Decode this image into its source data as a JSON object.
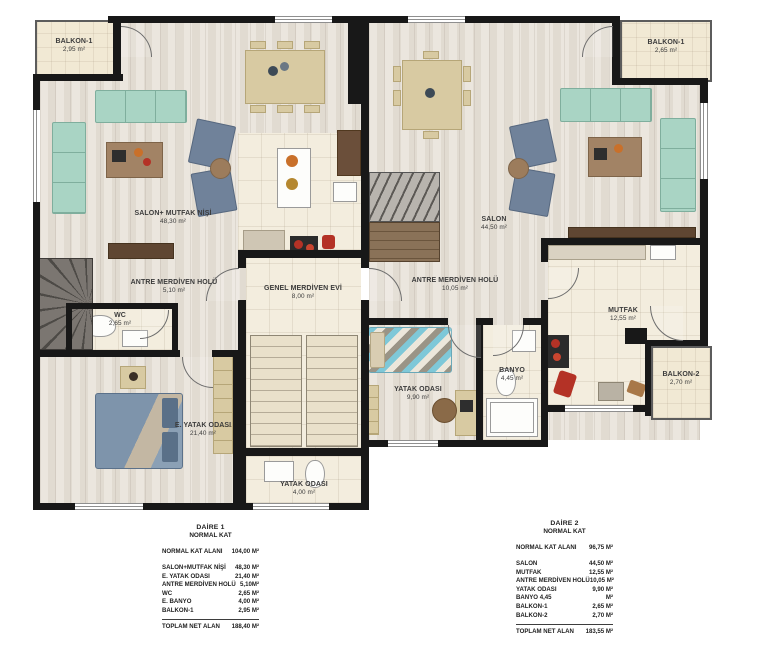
{
  "plan": {
    "rooms": [
      {
        "name": "BALKON-1",
        "area": "2,95 m²"
      },
      {
        "name": "SALON+ MUTFAK NİŞİ",
        "area": "48,30 m²"
      },
      {
        "name": "ANTRE MERDİVEN HOLÜ",
        "area": "5,10 m²"
      },
      {
        "name": "WC",
        "area": "2,65 m²"
      },
      {
        "name": "E. YATAK ODASI",
        "area": "21,40 m²"
      },
      {
        "name": "YATAK ODASI",
        "area": "4,00 m²"
      },
      {
        "name": "GENEL MERDİVEN EVİ",
        "area": "8,00 m²"
      },
      {
        "name": "SALON",
        "area": "44,50 m²"
      },
      {
        "name": "ANTRE MERDİVEN HOLÜ",
        "area": "10,05 m²"
      },
      {
        "name": "YATAK ODASI",
        "area": "9,90 m²"
      },
      {
        "name": "BANYO",
        "area": "4,45 m²"
      },
      {
        "name": "MUTFAK",
        "area": "12,55 m²"
      },
      {
        "name": "BALKON-2",
        "area": "2,70 m²"
      },
      {
        "name": "BALKON-1",
        "area": "2,65 m²"
      }
    ]
  },
  "tables": [
    {
      "title": "DAİRE 1",
      "subtitle": "NORMAL KAT",
      "summary": {
        "label": "NORMAL KAT ALANI",
        "value": "104,00 M²"
      },
      "rows": [
        {
          "label": "SALON+MUTFAK NİŞİ",
          "value": "48,30 M²"
        },
        {
          "label": "E. YATAK ODASI",
          "value": "21,40 M²"
        },
        {
          "label": "ANTRE MERDİVEN HOLÜ",
          "value": "5,10M²"
        },
        {
          "label": "WC",
          "value": "2,65 M²"
        },
        {
          "label": "E. BANYO",
          "value": "4,00 M²"
        },
        {
          "label": "BALKON-1",
          "value": "2,95 M²"
        }
      ],
      "total": {
        "label": "TOPLAM NET ALAN",
        "value": "188,40 M²"
      }
    },
    {
      "title": "DAİRE 2",
      "subtitle": "NORMAL KAT",
      "summary": {
        "label": "NORMAL KAT ALANI",
        "value": "96,75 M²"
      },
      "rows": [
        {
          "label": "SALON",
          "value": "44,50 M²"
        },
        {
          "label": "MUTFAK",
          "value": "12,55 M²"
        },
        {
          "label": "ANTRE MERDİVEN HOLÜ",
          "value": "10,05 M²"
        },
        {
          "label": "YATAK ODASI",
          "value": "9,90 M²"
        },
        {
          "label": "BANYO 4,45",
          "value": "M²"
        },
        {
          "label": "BALKON-1",
          "value": "2,65 M²"
        },
        {
          "label": "BALKON-2",
          "value": "2,70 M²"
        }
      ],
      "total": {
        "label": "TOPLAM NET ALAN",
        "value": "183,55 M²"
      }
    }
  ],
  "colors": {
    "wall": "#181818",
    "wood_floor": "#e7e1d8",
    "tile_floor": "#f3edde",
    "sofa_mint": "#a9d4c4",
    "sofa_slate": "#70829a",
    "accent_red": "#b43226",
    "bed_blue": "#7e94ab",
    "bed_cyan": "#7ec8d8"
  }
}
